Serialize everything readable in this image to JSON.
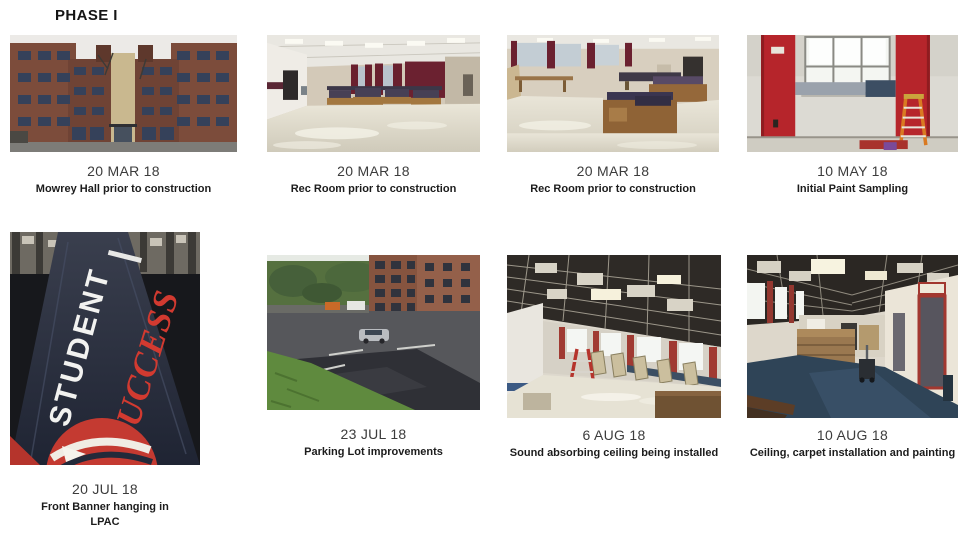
{
  "slide": {
    "title": "PHASE I"
  },
  "colors": {
    "accent_red": "#b6252b",
    "banner_navy": "#232a3a",
    "banner_red": "#d23a30"
  },
  "cards": [
    {
      "date": "20 MAR 18",
      "caption": "Mowrey Hall prior to construction",
      "photo": "mowrey-hall-exterior"
    },
    {
      "date": "20 MAR 18",
      "caption": "Rec Room prior to construction",
      "photo": "rec-room-interior-1"
    },
    {
      "date": "20 MAR 18",
      "caption": "Rec Room prior to construction",
      "photo": "rec-room-interior-2"
    },
    {
      "date": "10 MAY 18",
      "caption": "Initial Paint Sampling",
      "photo": "paint-sampling-room"
    },
    {
      "date": "20 JUL 18",
      "caption": "Front Banner hanging in LPAC",
      "photo": "student-success-banner",
      "banner_line1": "STUDENT",
      "banner_line2": "SUCCESS"
    },
    {
      "date": "23 JUL 18",
      "caption": "Parking Lot improvements",
      "photo": "parking-lot"
    },
    {
      "date": "6 AUG 18",
      "caption": "Sound absorbing ceiling being installed",
      "photo": "ceiling-installation"
    },
    {
      "date": "10 AUG 18",
      "caption": "Ceiling, carpet installation and painting",
      "photo": "carpet-installation"
    }
  ]
}
